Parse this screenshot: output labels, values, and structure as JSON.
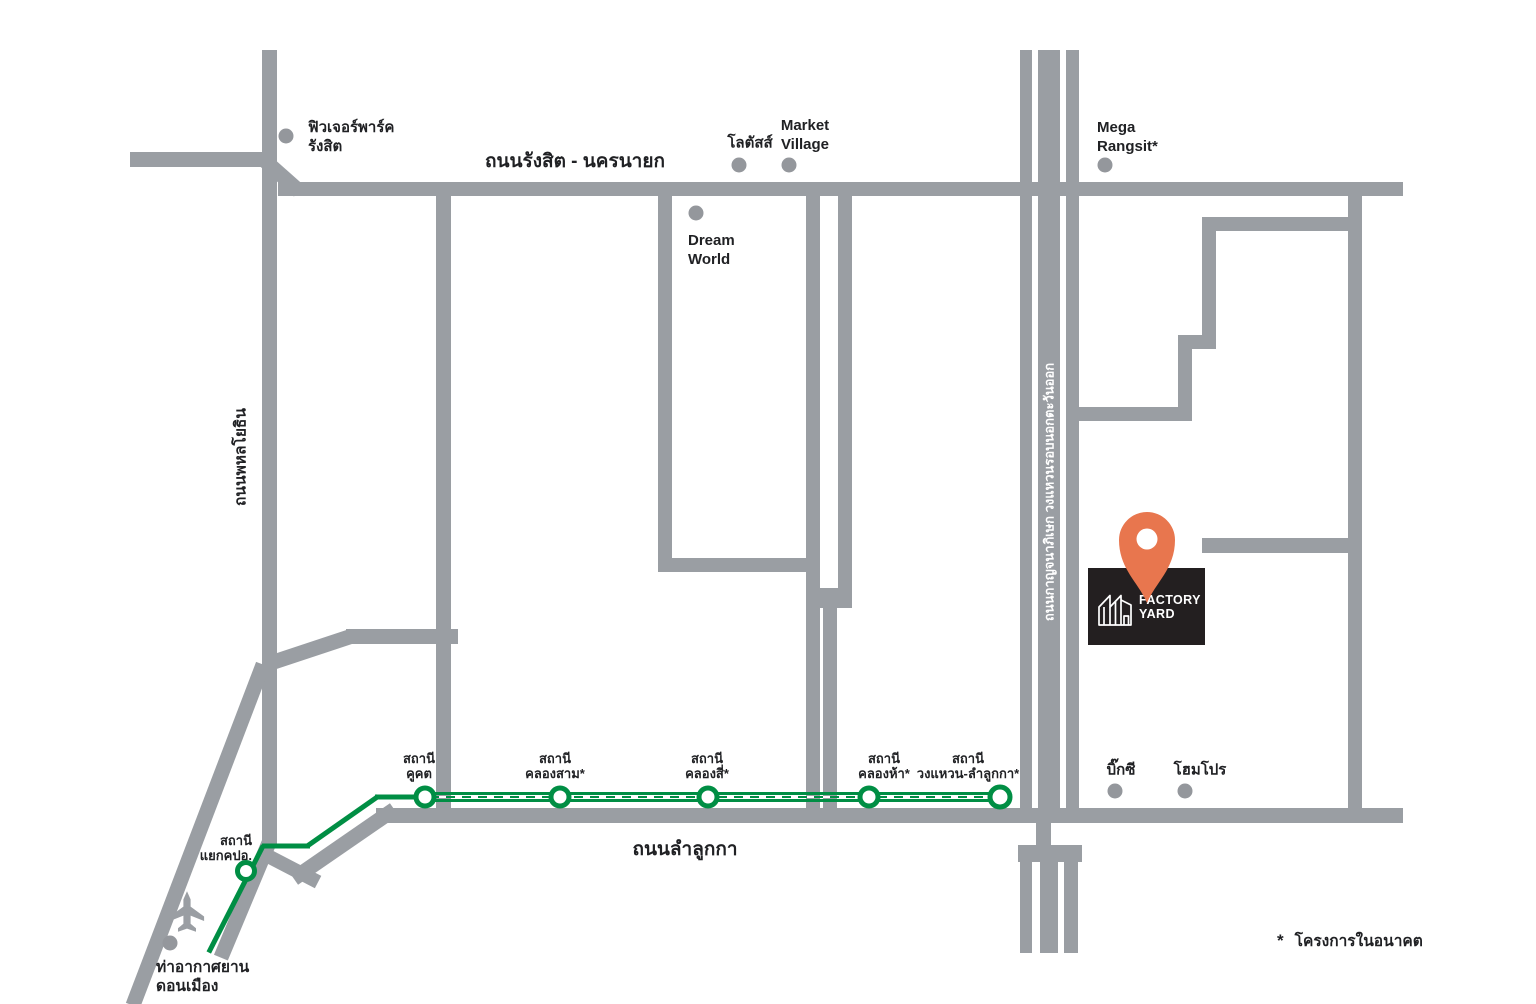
{
  "colors": {
    "road": "#9a9ea3",
    "dot": "#94979c",
    "green": "#008e44",
    "orange": "#e8764e",
    "ink": "#231f20",
    "text": "#202124"
  },
  "roads": {
    "rangsit_nakhonnayok": "ถนนรังสิต - นครนายก",
    "phahonyothin": "ถนนพหลโยธิน",
    "lamlukka": "ถนนลำลูกกา",
    "kanchanaphisek": "ถนนกาญจนาภิเษก วงแหวนรอบนอกตะวันออก"
  },
  "landmarks": {
    "future_park": {
      "line1": "ฟิวเจอร์พาร์ค",
      "line2": "รังสิต"
    },
    "lotus": {
      "line1": "โลตัสส์"
    },
    "market_village": {
      "line1": "Market",
      "line2": "Village"
    },
    "dream_world": {
      "line1": "Dream",
      "line2": "World"
    },
    "mega_rangsit": {
      "line1": "Mega",
      "line2": "Rangsit*"
    },
    "big_c": {
      "line1": "บิ๊กซี"
    },
    "homepro": {
      "line1": "โฮมโปร"
    },
    "don_mueang_airport": {
      "line1": "ท่าอากาศยาน",
      "line2": "ดอนเมือง"
    }
  },
  "stations": {
    "khukhot": {
      "line1": "สถานี",
      "line2": "คูคต"
    },
    "khlong_sam": {
      "line1": "สถานี",
      "line2": "คลองสาม*"
    },
    "khlong_si": {
      "line1": "สถานี",
      "line2": "คลองสี่*"
    },
    "khlong_ha": {
      "line1": "สถานี",
      "line2": "คลองห้า*"
    },
    "wongwaen_lamlukka": {
      "line1": "สถานี",
      "line2": "วงแหวน-ลำลูกกา*"
    },
    "yaek_kopoo": {
      "line1": "สถานี",
      "line2": "แยกคปอ."
    }
  },
  "legend": {
    "marker": "*",
    "text": "โครงการในอนาคต"
  },
  "logo": {
    "line1": "FACTORY",
    "line2": "YARD"
  },
  "icons": {
    "airplane": "airplane-icon",
    "factory": "factory-icon",
    "location_pin": "location-pin-icon"
  }
}
